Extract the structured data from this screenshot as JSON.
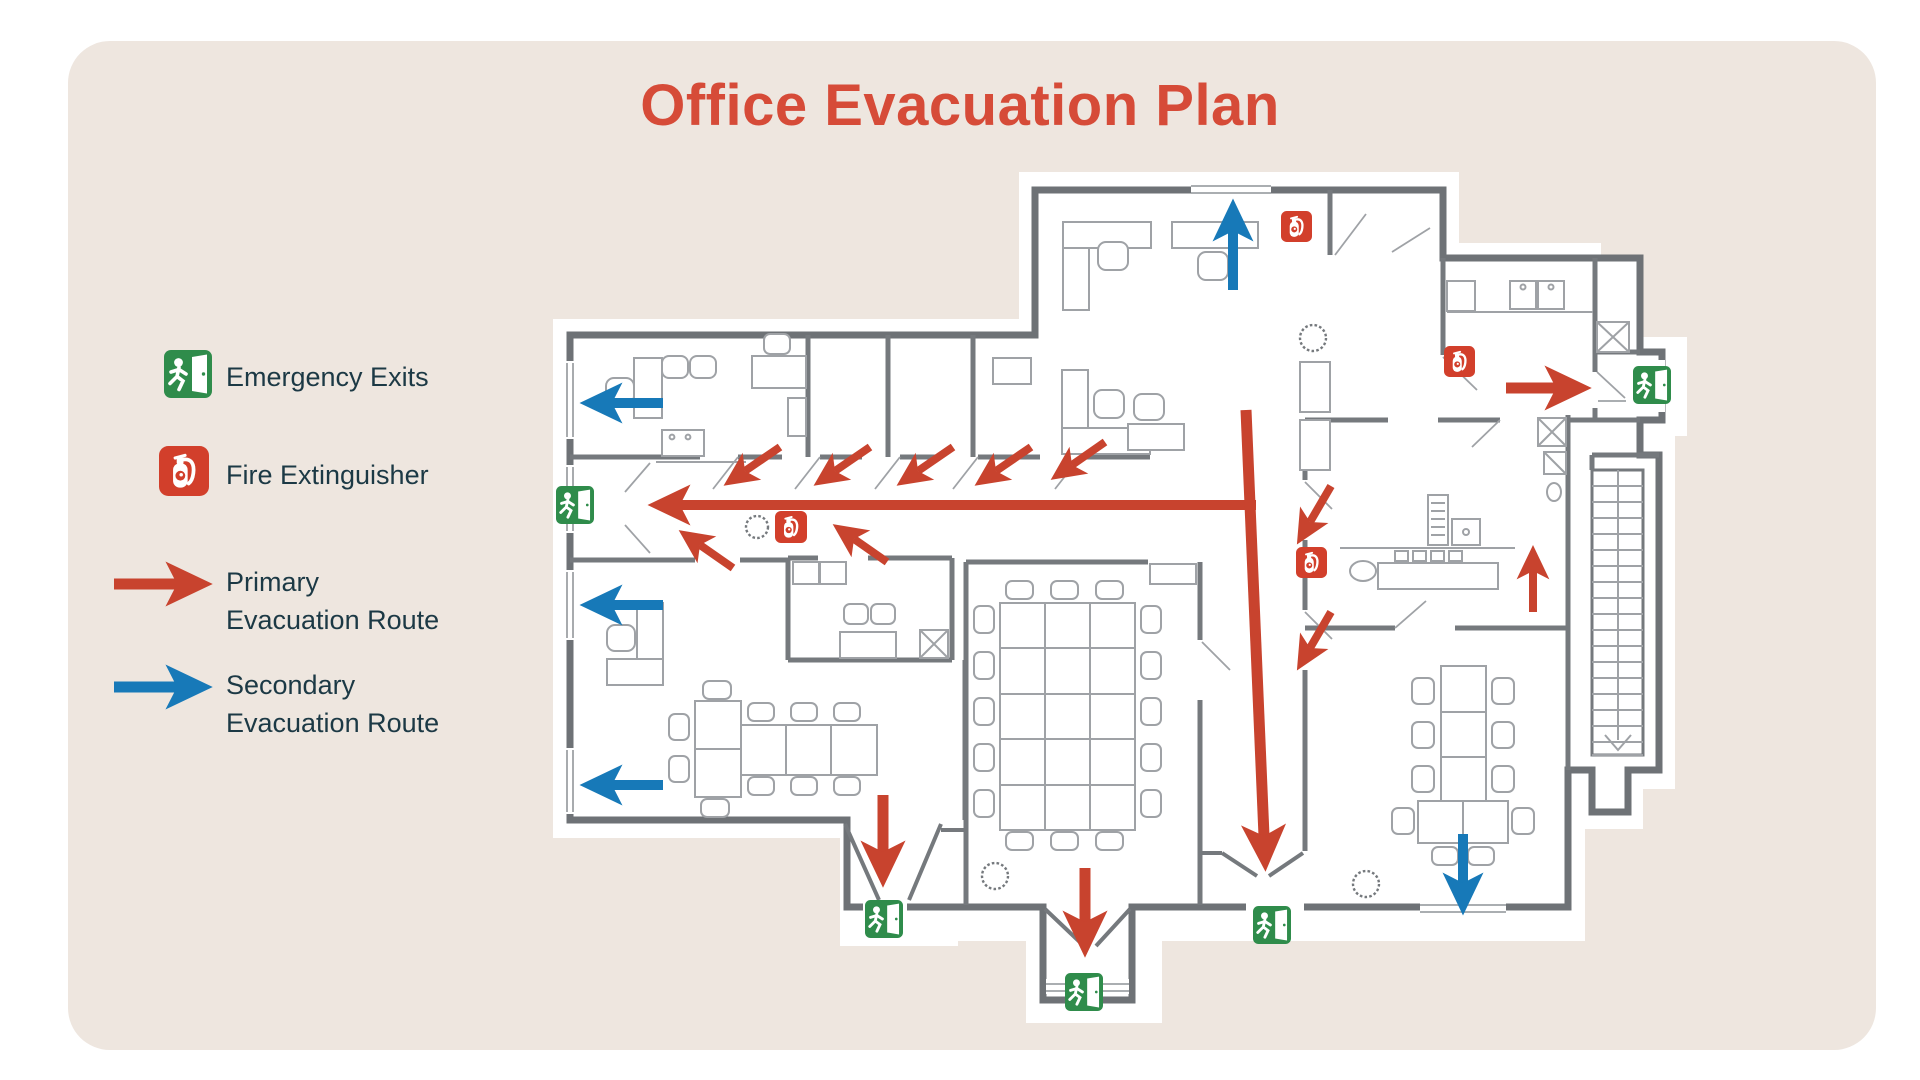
{
  "title": "Office Evacuation Plan",
  "colors": {
    "canvas_beige": "#EEE6DF",
    "title_red": "#D64B38",
    "text_dark": "#1C3945",
    "route_primary": "#C8432E",
    "route_secondary": "#1779B8",
    "exit_green": "#2F8C4B",
    "extinguisher_red": "#D23F2B"
  },
  "legend": {
    "items": [
      {
        "id": "emergency-exits",
        "icon": "exit-sign-icon",
        "label": "Emergency Exits"
      },
      {
        "id": "fire-extinguisher",
        "icon": "fire-extinguisher-icon",
        "label": "Fire Extinguisher"
      },
      {
        "id": "primary-route",
        "icon": "red-arrow-icon",
        "label": "Primary\nEvacuation Route"
      },
      {
        "id": "secondary-route",
        "icon": "blue-arrow-icon",
        "label": "Secondary\nEvacuation Route"
      }
    ]
  },
  "plan": {
    "exit_signs": [
      {
        "x": 164,
        "y": 350,
        "size": 48,
        "legend": true
      },
      {
        "x": 556,
        "y": 486,
        "size": 38
      },
      {
        "x": 1633,
        "y": 366,
        "size": 38
      },
      {
        "x": 865,
        "y": 900,
        "size": 38
      },
      {
        "x": 1065,
        "y": 973,
        "size": 38
      },
      {
        "x": 1253,
        "y": 906,
        "size": 38
      }
    ],
    "extinguisher_signs": [
      {
        "x": 159,
        "y": 446,
        "size": 50,
        "legend": true
      },
      {
        "x": 1281,
        "y": 211,
        "size": 31
      },
      {
        "x": 1444,
        "y": 346,
        "size": 31
      },
      {
        "x": 775,
        "y": 511,
        "size": 32
      },
      {
        "x": 1296,
        "y": 547,
        "size": 31
      }
    ],
    "routes": {
      "primary": [
        {
          "x1": 114,
          "y1": 584,
          "x2": 177,
          "y2": 584,
          "w": 11,
          "legend": true
        },
        {
          "x1": 1256,
          "y1": 505,
          "x2": 680,
          "y2": 505,
          "w": 10
        },
        {
          "x1": 780,
          "y1": 447,
          "x2": 745,
          "y2": 471,
          "w": 8
        },
        {
          "x1": 870,
          "y1": 447,
          "x2": 835,
          "y2": 471,
          "w": 8
        },
        {
          "x1": 953,
          "y1": 447,
          "x2": 918,
          "y2": 471,
          "w": 8
        },
        {
          "x1": 1031,
          "y1": 447,
          "x2": 996,
          "y2": 471,
          "w": 8
        },
        {
          "x1": 1105,
          "y1": 442,
          "x2": 1072,
          "y2": 465,
          "w": 8
        },
        {
          "x1": 733,
          "y1": 568,
          "x2": 700,
          "y2": 545,
          "w": 8
        },
        {
          "x1": 887,
          "y1": 562,
          "x2": 854,
          "y2": 539,
          "w": 8
        },
        {
          "x1": 1246,
          "y1": 410,
          "x2": 1264,
          "y2": 836,
          "w": 11
        },
        {
          "x1": 1331,
          "y1": 486,
          "x2": 1310,
          "y2": 522,
          "w": 8
        },
        {
          "x1": 1331,
          "y1": 612,
          "x2": 1310,
          "y2": 648,
          "w": 8
        },
        {
          "x1": 1533,
          "y1": 612,
          "x2": 1533,
          "y2": 571,
          "w": 8
        },
        {
          "x1": 1506,
          "y1": 388,
          "x2": 1556,
          "y2": 388,
          "w": 11
        },
        {
          "x1": 883,
          "y1": 795,
          "x2": 883,
          "y2": 852,
          "w": 11
        },
        {
          "x1": 1085,
          "y1": 868,
          "x2": 1085,
          "y2": 922,
          "w": 11
        }
      ],
      "secondary": [
        {
          "x1": 114,
          "y1": 687,
          "x2": 177,
          "y2": 687,
          "w": 11,
          "legend": true
        },
        {
          "x1": 1233,
          "y1": 290,
          "x2": 1233,
          "y2": 231,
          "w": 10
        },
        {
          "x1": 663,
          "y1": 403,
          "x2": 612,
          "y2": 403,
          "w": 10
        },
        {
          "x1": 663,
          "y1": 605,
          "x2": 612,
          "y2": 605,
          "w": 10
        },
        {
          "x1": 663,
          "y1": 785,
          "x2": 612,
          "y2": 785,
          "w": 10
        },
        {
          "x1": 1463,
          "y1": 834,
          "x2": 1463,
          "y2": 883,
          "w": 10
        }
      ]
    }
  }
}
